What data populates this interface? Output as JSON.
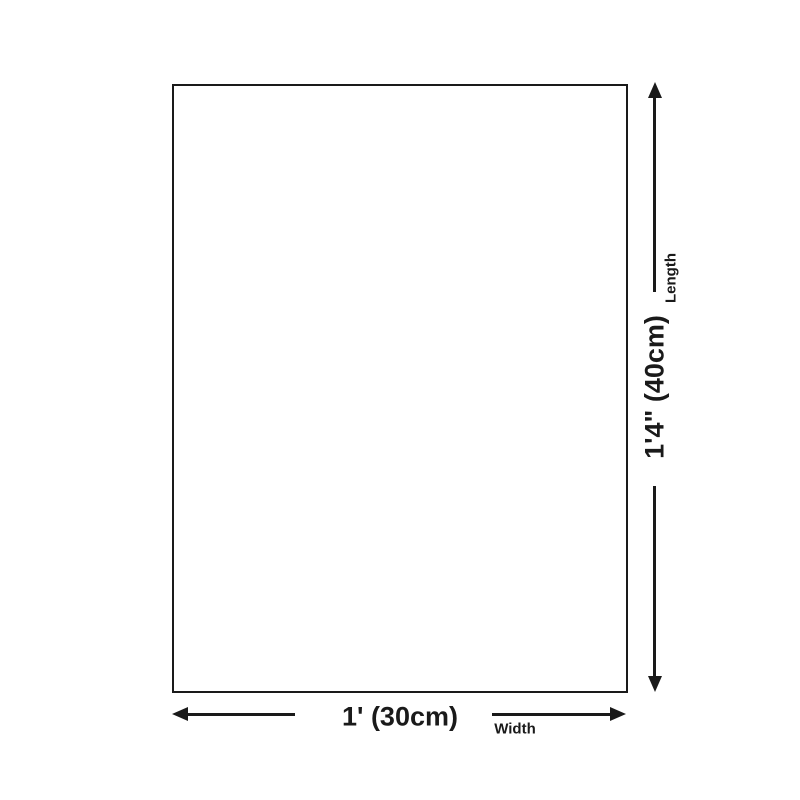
{
  "diagram": {
    "background_color": "#ffffff",
    "line_color": "#1a1a1a",
    "length_dimension": {
      "value": "1'4\" (40cm)",
      "label": "Length"
    },
    "width_dimension": {
      "value": "1' (30cm)",
      "label": "Width"
    }
  }
}
